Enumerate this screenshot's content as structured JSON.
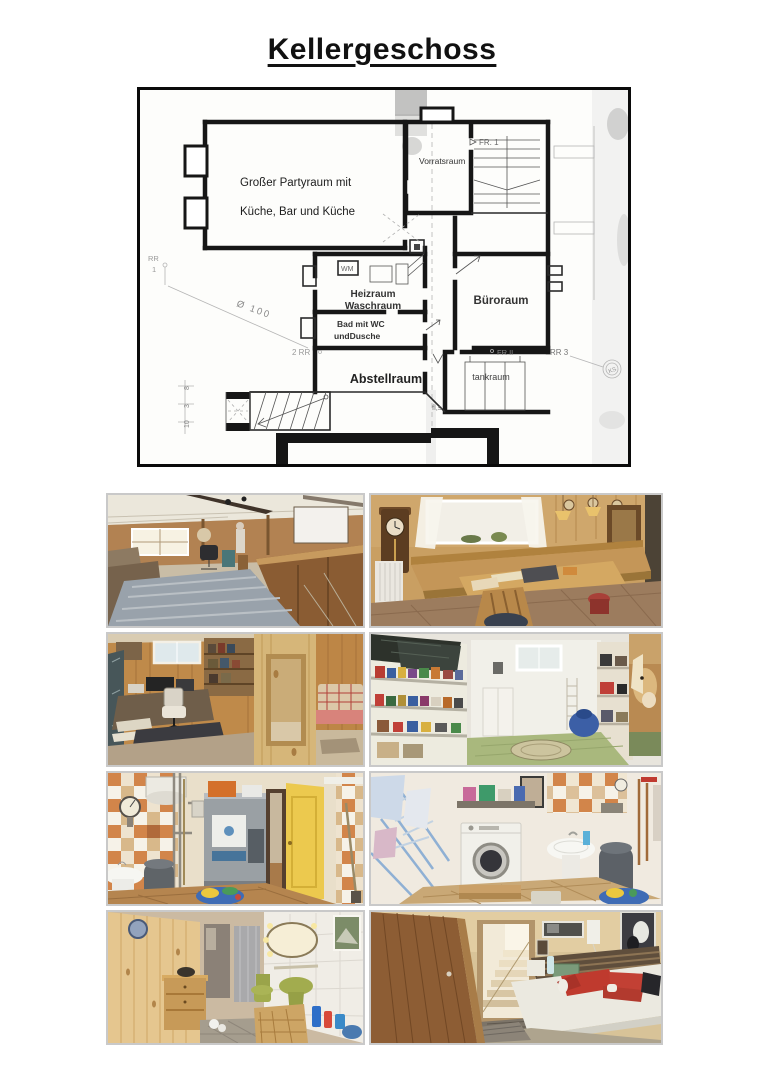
{
  "page": {
    "title": "Kellergeschoss",
    "background": "#ffffff"
  },
  "colors": {
    "plan_frame": "#0a0a0a",
    "plan_lines": "#161616",
    "photo_frame": "#c9c9c9"
  },
  "floorplan": {
    "rooms": {
      "partyraum1": "Großer Partyraum mit",
      "partyraum2": "Küche, Bar und Küche",
      "vorratsraum": "Vorratsraum",
      "heizraum1": "Heizraum",
      "heizraum2": "Waschraum",
      "bueroraum": "Büroraum",
      "bad1": "Bad mit WC",
      "bad2": "undDusche",
      "abstellraum": "Abstellraum",
      "tankraum": "tankraum"
    },
    "annotations": {
      "fr1": "FR. 1",
      "frii": "FR II",
      "wm": "WM",
      "rr": "RR",
      "rr_nr": "1",
      "rr2": "2 RR",
      "rr3": "RR 3",
      "diameter": "Ø 100",
      "fls": "fl,s",
      "ks": "KS",
      "dim1": "8",
      "dim2": "3",
      "dim3": "10"
    }
  },
  "photos": [
    {
      "id": "partyroom",
      "desc": "Großer Partyraum mit Bar, Theke und Teppich"
    },
    {
      "id": "essecke",
      "desc": "Essecke mit Eckbank, Tisch und Wanduhr"
    },
    {
      "id": "arbeitszimmer",
      "desc": "Arbeitszimmer mit Schreibtisch und Holzvertäfelung"
    },
    {
      "id": "vorratsraum",
      "desc": "Vorratsraum mit Regalen und Pferdeposter"
    },
    {
      "id": "heizraum",
      "desc": "Heizraum mit Heizkessel und Waschbecken"
    },
    {
      "id": "waschraum",
      "desc": "Waschraum mit Waschmaschine und Wäscheständer"
    },
    {
      "id": "bad",
      "desc": "Bad mit WC und Dusche"
    },
    {
      "id": "kellerraum",
      "desc": "Kellerraum mit Treppenaufgang"
    }
  ]
}
